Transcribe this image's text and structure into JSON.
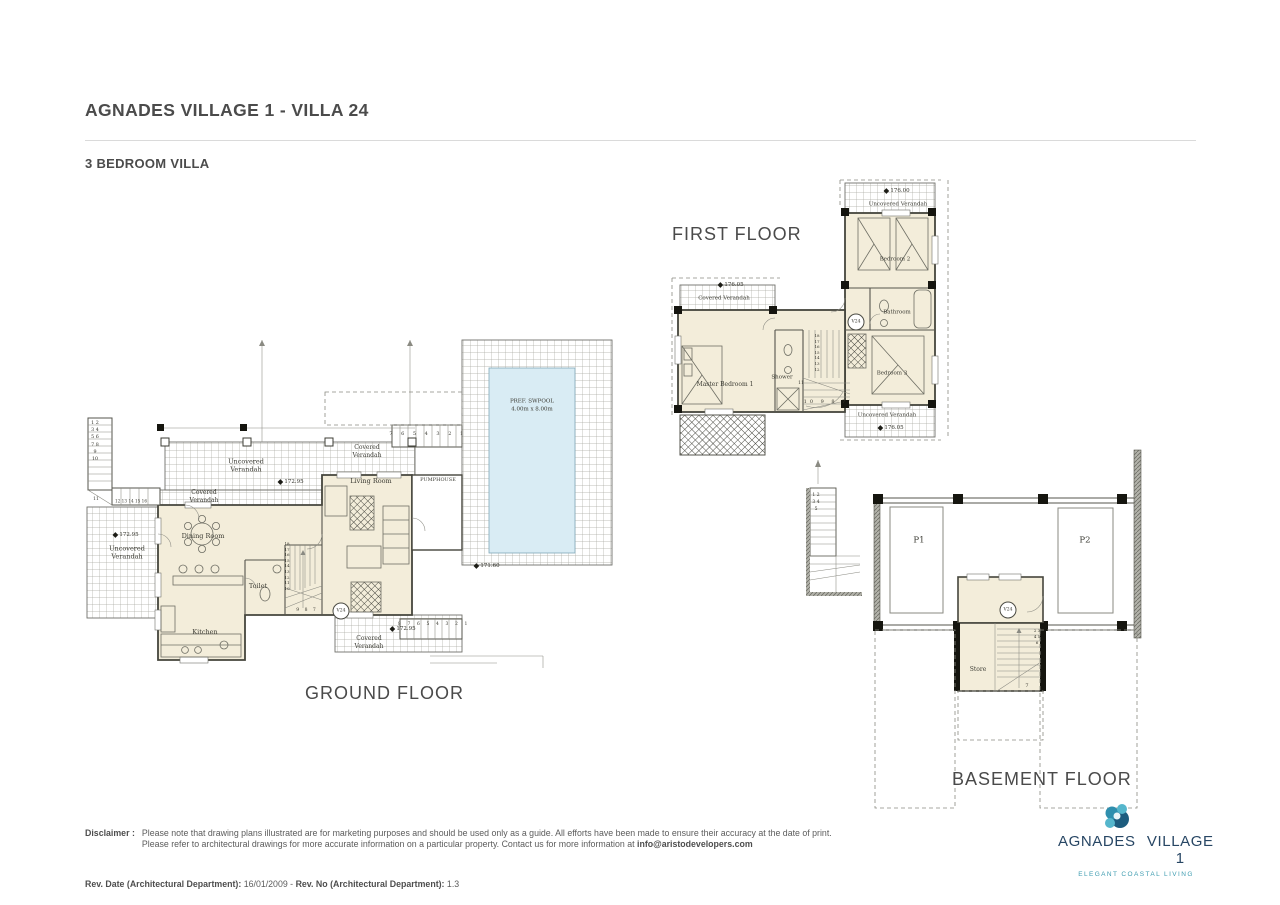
{
  "page": {
    "title": "AGNADES VILLAGE 1 - VILLA 24",
    "subtitle": "3 BEDROOM VILLA"
  },
  "ground_floor": {
    "title": "GROUND FLOOR",
    "rooms": {
      "dining_room": "Dining Room",
      "living_room": "Living Room",
      "kitchen": "Kitchen",
      "toilet": "Toilet",
      "pumphouse": "PUMPHOUSE"
    },
    "verandahs": {
      "uncovered_top": "Uncovered Verandah",
      "covered_upper_right": "Covered Verandah",
      "covered_left": "Covered Verandah",
      "uncovered_left": "Uncovered Verandah",
      "covered_bottom": "Covered Verandah"
    },
    "pool": {
      "name": "PREF. SWPOOL",
      "size": "4.00m x 8.00m"
    },
    "levels": {
      "top": "172.95",
      "left": "172.95",
      "bottom": "172.95",
      "pool_deck": "171.60"
    },
    "villa_marker": "V24",
    "stairs": {
      "top_row": "7 6 5 4 3 2 1",
      "bottom_row": "8 7 6 5 4 3 2 1",
      "left_column": "1 2 3 4 5 6 7 8 9 10",
      "left_turn_label": "11",
      "left_run": "12 13 14 15 16",
      "interior_column": "18 17 16 15 14 13 12 11 10",
      "interior_row": "9 8 7"
    }
  },
  "first_floor": {
    "title": "FIRST FLOOR",
    "rooms": {
      "master_bedroom": "Master Bedroom 1",
      "bedroom_2": "Bedroom 2",
      "bedroom_3": "Bedroom 3",
      "bathroom": "Bathroom",
      "shower": "Shower"
    },
    "verandahs": {
      "uncovered_top": "Uncovered Verandah",
      "uncovered_bottom": "Uncovered Verandah",
      "covered_left": "Covered Verandah"
    },
    "levels": {
      "top": "176.00",
      "bottom": "176.05",
      "left": "176.05"
    },
    "villa_marker": "V24",
    "stairs": {
      "bottom_row": "10 9 8 7",
      "column": "18 17 16 15 14 13 12",
      "turn_label": "11"
    }
  },
  "basement_floor": {
    "title": "BASEMENT FLOOR",
    "rooms": {
      "parking_1": "P1",
      "parking_2": "P2",
      "store": "Store"
    },
    "villa_marker": "V24",
    "stairs": {
      "external_column": "1 2 3 4 5",
      "store_column": "2 3 4 5 6",
      "store_last": "7"
    }
  },
  "footer": {
    "disclaimer_label": "Disclaimer :",
    "disclaimer_line1": "Please note that drawing plans illustrated are for marketing purposes and should be used only as a guide. All efforts have been made to ensure their accuracy at the date of print.",
    "disclaimer_line2": "Please refer to architectural drawings for more accurate information on a particular property. Contact us for more information at ",
    "disclaimer_email": "info@aristodevelopers.com",
    "rev_date_label": "Rev. Date (Architectural Department):",
    "rev_date_value": " 16/01/2009 - ",
    "rev_no_label": "Rev. No (Architectural Department):",
    "rev_no_value": " 1.3"
  },
  "logo": {
    "name_left": "AGNADES",
    "name_right": "VILLAGE 1",
    "tagline": "ELEGANT COASTAL LIVING"
  },
  "colors": {
    "room_fill": "#f3edda",
    "pool_fill": "#d9ecf4",
    "logo_navy": "#274664",
    "logo_teal": "#3e9cb0"
  }
}
